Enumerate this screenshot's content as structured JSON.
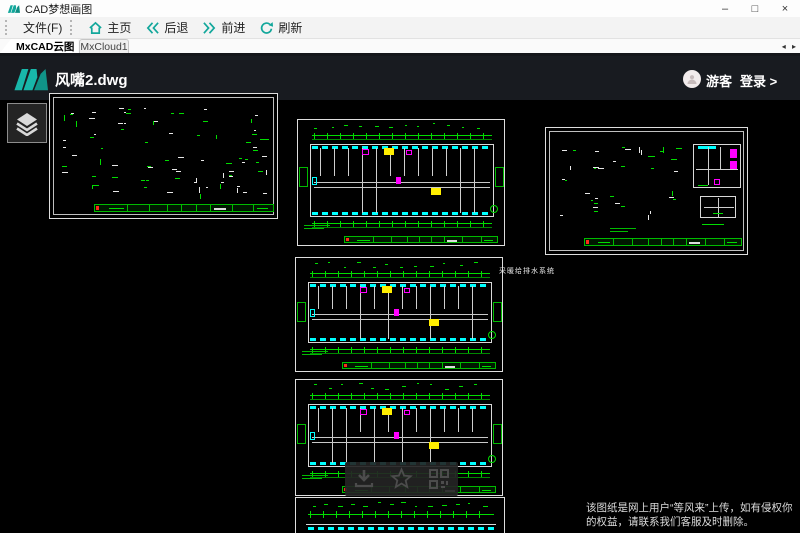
{
  "window": {
    "title": "CAD梦想画图",
    "minimize": "–",
    "maximize": "□",
    "close": "×"
  },
  "menubar": {
    "file": "文件(F)"
  },
  "toolbar": {
    "home": "主页",
    "back": "后退",
    "forward": "前进",
    "refresh": "刷新"
  },
  "tabbar": {
    "tabs": [
      {
        "label": "MxCAD云图"
      },
      {
        "label": "MxCloud1"
      }
    ],
    "scroll_arrows": "◂ ▸"
  },
  "viewer": {
    "doc_title": "风嘴2.dwg",
    "user_label": "游客",
    "login_label": "登录 >",
    "drawing_note": "采暖给排水系统",
    "watermark_line1": "该图纸是网上用户“等风来”上传，如有侵权你",
    "watermark_line2": "的权益，请联系我们客服及时删除。"
  },
  "icons": {
    "app_logo": "mxcad-logo",
    "home": "home-icon",
    "back": "double-chevron-left-icon",
    "forward": "double-chevron-right-icon",
    "refresh": "refresh-icon",
    "avatar": "user-avatar-icon",
    "layers": "layers-icon",
    "download": "download-icon",
    "favorite": "star-icon",
    "qrcode": "qrcode-icon"
  },
  "colors": {
    "accent_teal": "#12a79b",
    "cad_green": "#00dd00",
    "cad_cyan": "#00ffff",
    "cad_magenta": "#ff00ff",
    "cad_yellow": "#ffee00",
    "cad_red": "#ff2a1a",
    "header_dark": "#181b20",
    "canvas_black": "#000000"
  }
}
